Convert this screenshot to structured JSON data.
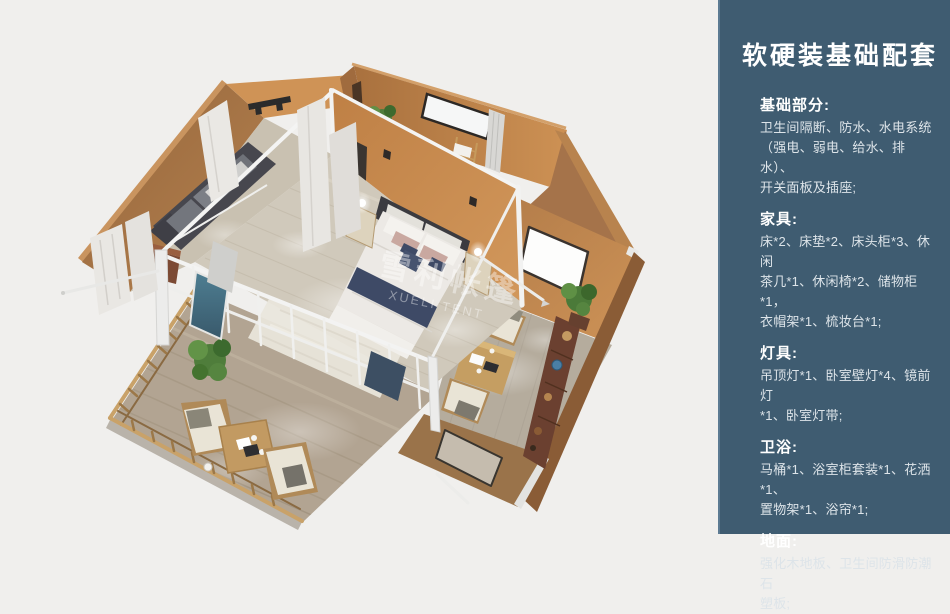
{
  "panel": {
    "title": "软硬装基础配套",
    "background_color": "#3f5c71",
    "heading_color": "#ffffff",
    "body_color": "#dde4e9",
    "sections": [
      {
        "heading": "基础部分:",
        "lines": [
          "卫生间隔断、防水、水电系统",
          "（强电、弱电、给水、排水）、",
          "开关面板及插座;"
        ]
      },
      {
        "heading": "家具:",
        "lines": [
          "床*2、床垫*2、床头柜*3、休闲",
          "茶几*1、休闲椅*2、储物柜*1，",
          "衣帽架*1、梳妆台*1;"
        ]
      },
      {
        "heading": "灯具:",
        "lines": [
          "吊顶灯*1、卧室壁灯*4、镜前灯",
          "*1、卧室灯带;"
        ]
      },
      {
        "heading": "卫浴:",
        "lines": [
          "马桶*1、浴室柜套装*1、花洒*1、",
          "置物架*1、浴帘*1;"
        ]
      },
      {
        "heading": "地面:",
        "lines": [
          "强化木地板、卫生间防滑防潮石",
          "塑板;"
        ]
      }
    ]
  },
  "scene": {
    "watermark": {
      "cn": "雪利帐篷",
      "en": "XUELI TENT"
    },
    "background_color": "#f0efed",
    "colors": {
      "wall_exterior_tan": "#a9784c",
      "wall_interior_orange": "#c98b50",
      "wall_shadow_brown": "#8a5c36",
      "floor_wood": "#d0c9bb",
      "deck_wood": "#b2a492",
      "frame_white": "#f2f2f1",
      "sofa_gray": "#47474e",
      "bedding_white": "#ece9e5",
      "bed_runner_navy": "#3e4a66",
      "pillow_mauve": "#c9a8a0",
      "plant_green": "#4f7c3b",
      "cabinet_brown": "#6b4030",
      "curtain_white": "#e9e7e3",
      "glass_door_teal": "#44707f"
    }
  }
}
